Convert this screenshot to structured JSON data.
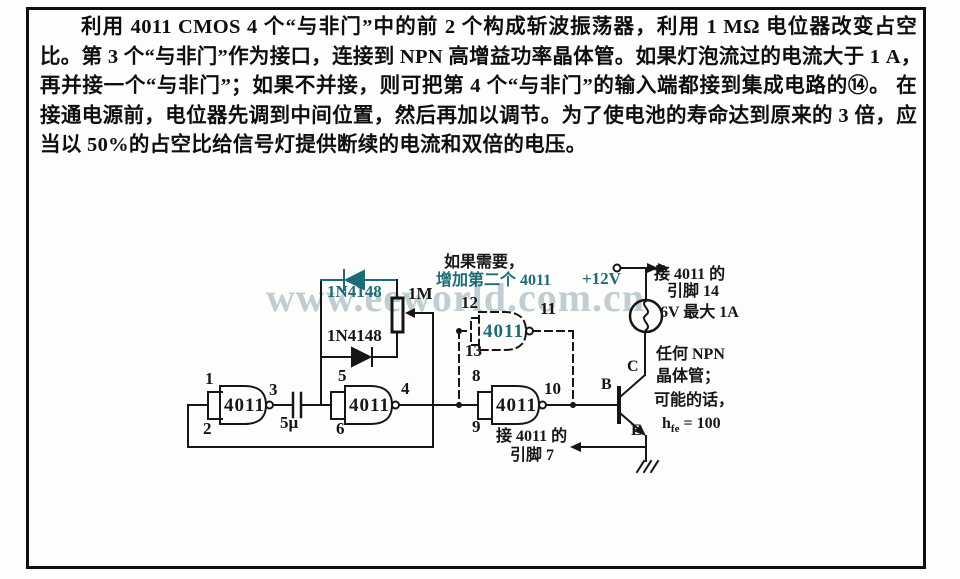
{
  "document": {
    "paragraph": {
      "lines": [
        "利用 4011 CMOS 4 个“与非门”中的前 2 个构成斩波振荡器，利用 1 MΩ 电位器改变占空",
        "比。第 3 个“与非门”作为接口，连接到 NPN 高增益功率晶体管。如果灯泡流过的电流大于 1 A，",
        "再并接一个“与非门”；如果不并接，则可把第 4 个“与非门”的输入端都接到集成电路的⑭。 在",
        "接通电源前，电位器先调到中间位置，然后再加以调节。为了使电池的寿命达到原来的 3 倍，应",
        "当以 50%的占空比给信号灯提供断续的电流和双倍的电压。"
      ]
    }
  },
  "watermark": {
    "text": "www.eeworld.com.cn",
    "color": "#b2c2c9"
  },
  "colors": {
    "ink": "#161616",
    "teal": "#1e6b78"
  },
  "circuit": {
    "gates": [
      {
        "label": "4011",
        "pins": {
          "in1": "1",
          "in2": "2",
          "out": "3"
        }
      },
      {
        "label": "4011",
        "pins": {
          "in1": "5",
          "in2": "6",
          "out": "4"
        }
      },
      {
        "label": "4011",
        "pins": {
          "in1": "8",
          "in2": "9",
          "out": "10"
        }
      },
      {
        "label": "4011",
        "pins": {
          "in1": "12",
          "in2": "13",
          "out": "11"
        }
      }
    ],
    "components": {
      "capacitor": "5μ",
      "potentiometer": "1M",
      "diode_top": "1N4148",
      "diode_bottom": "1N4148"
    },
    "annotations": {
      "optional_line1": "如果需要，",
      "optional_line2": "增加第二个 4011",
      "supply": "+12V",
      "pin14_line1": "接 4011 的",
      "pin14_line2": "引脚 14",
      "lamp_rating": "6V 最大 1A",
      "transistor_b": "B",
      "transistor_c": "C",
      "transistor_e": "E",
      "npn_line1": "任何 NPN",
      "npn_line2": "晶体管；",
      "npn_line3": "可能的话，",
      "hfe_base": "h",
      "hfe_sub": "fe",
      "hfe_eq": " = 100",
      "pin7_line1": "接 4011 的",
      "pin7_line2": "引脚 7"
    }
  }
}
